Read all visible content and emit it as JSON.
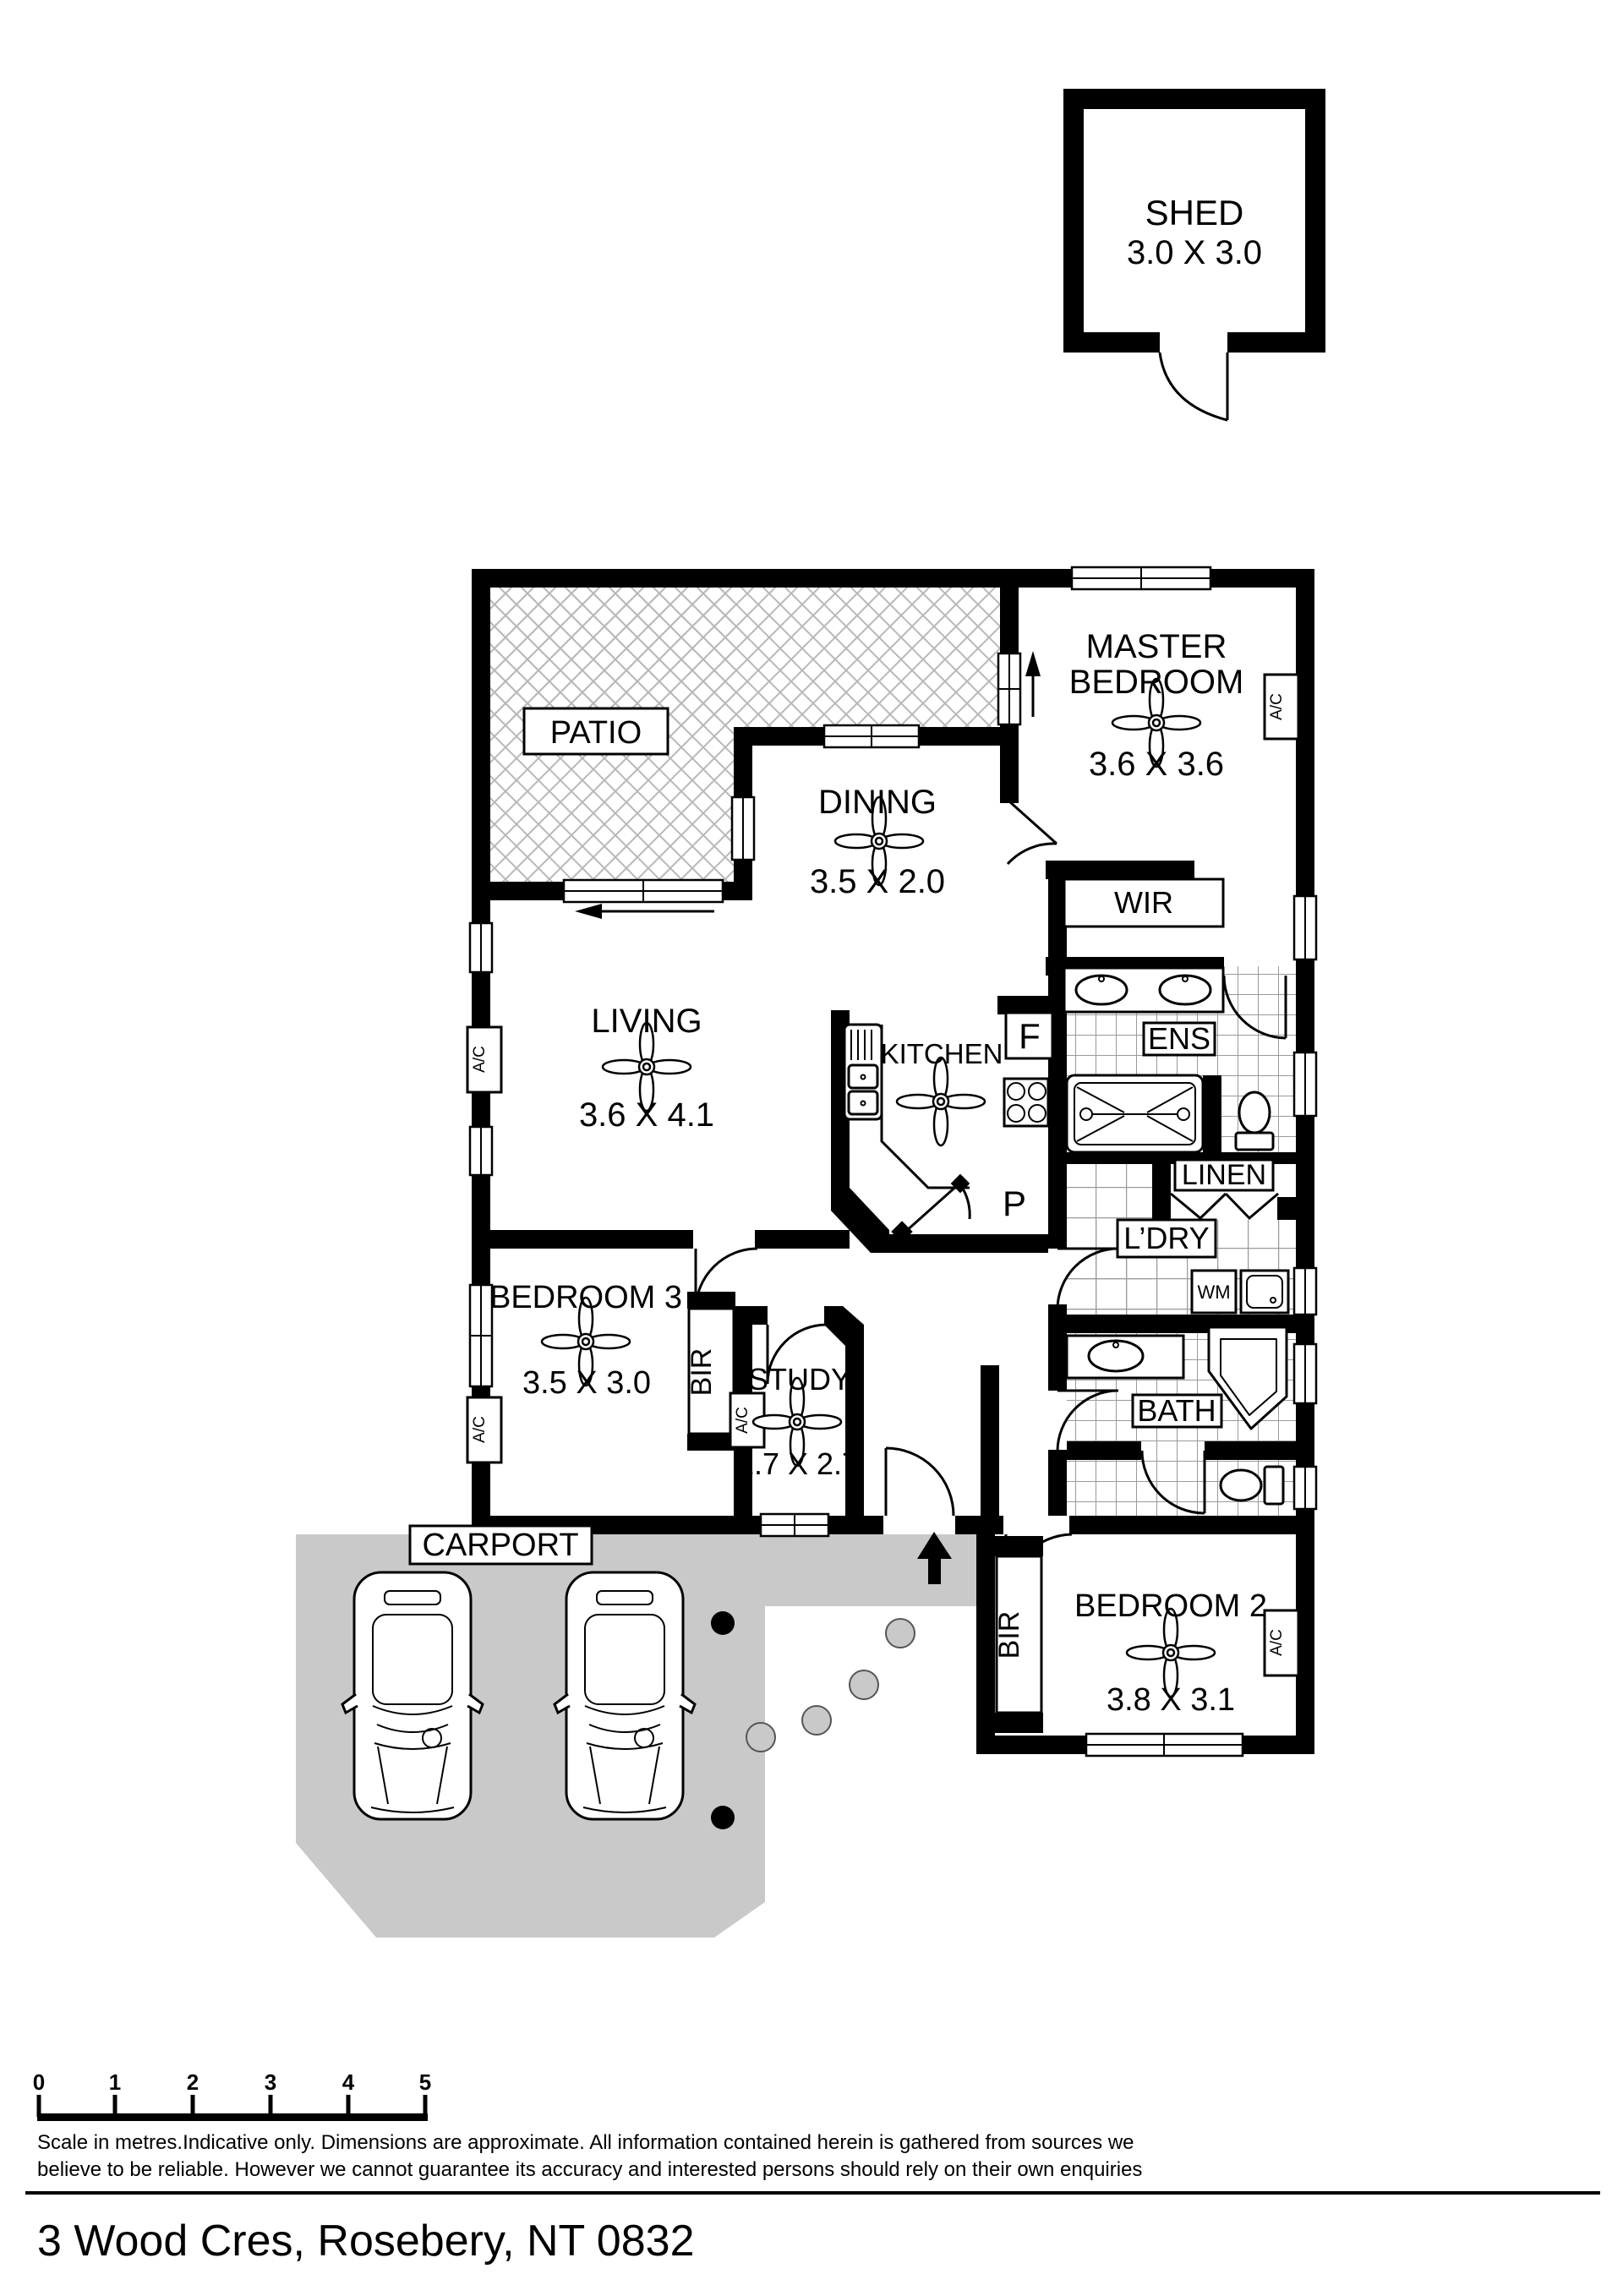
{
  "shed": {
    "label": "SHED",
    "dims": "3.0 X 3.0"
  },
  "rooms": {
    "patio": {
      "label": "PATIO"
    },
    "master": {
      "line1": "MASTER",
      "line2": "BEDROOM",
      "dims": "3.6 X 3.6"
    },
    "dining": {
      "label": "DINING",
      "dims": "3.5 X 2.0"
    },
    "wir": {
      "label": "WIR"
    },
    "ens": {
      "label": "ENS"
    },
    "linen": {
      "label": "LINEN"
    },
    "laundry": {
      "label": "L’DRY"
    },
    "living": {
      "label": "LIVING",
      "dims": "3.6 X 4.1"
    },
    "kitchen": {
      "label": "KITCHEN"
    },
    "bedroom3": {
      "label": "BEDROOM 3",
      "dims": "3.5 X 3.0"
    },
    "study": {
      "label": "STUDY",
      "dims": "1.7 X 2.7"
    },
    "bath": {
      "label": "BATH"
    },
    "carport": {
      "label": "CARPORT"
    },
    "bedroom2": {
      "label": "BEDROOM 2",
      "dims": "3.8 X 3.1"
    }
  },
  "fixtures": {
    "fridge": "F",
    "pantry": "P",
    "washing_machine": "WM",
    "built_in_robe": "BIR",
    "air_conditioner": "A/C"
  },
  "scale_bar": {
    "ticks": [
      "0",
      "1",
      "2",
      "3",
      "4",
      "5"
    ]
  },
  "disclaimer": {
    "line1": "Scale in metres.Indicative only. Dimensions are approximate. All information contained herein is gathered from sources we",
    "line2": "believe to be reliable. However we cannot guarantee its accuracy and interested persons should rely on their own enquiries"
  },
  "address": "3 Wood Cres, Rosebery, NT 0832",
  "colors": {
    "wall": "#000000",
    "carport": "#c9c9c9",
    "background": "#ffffff"
  }
}
